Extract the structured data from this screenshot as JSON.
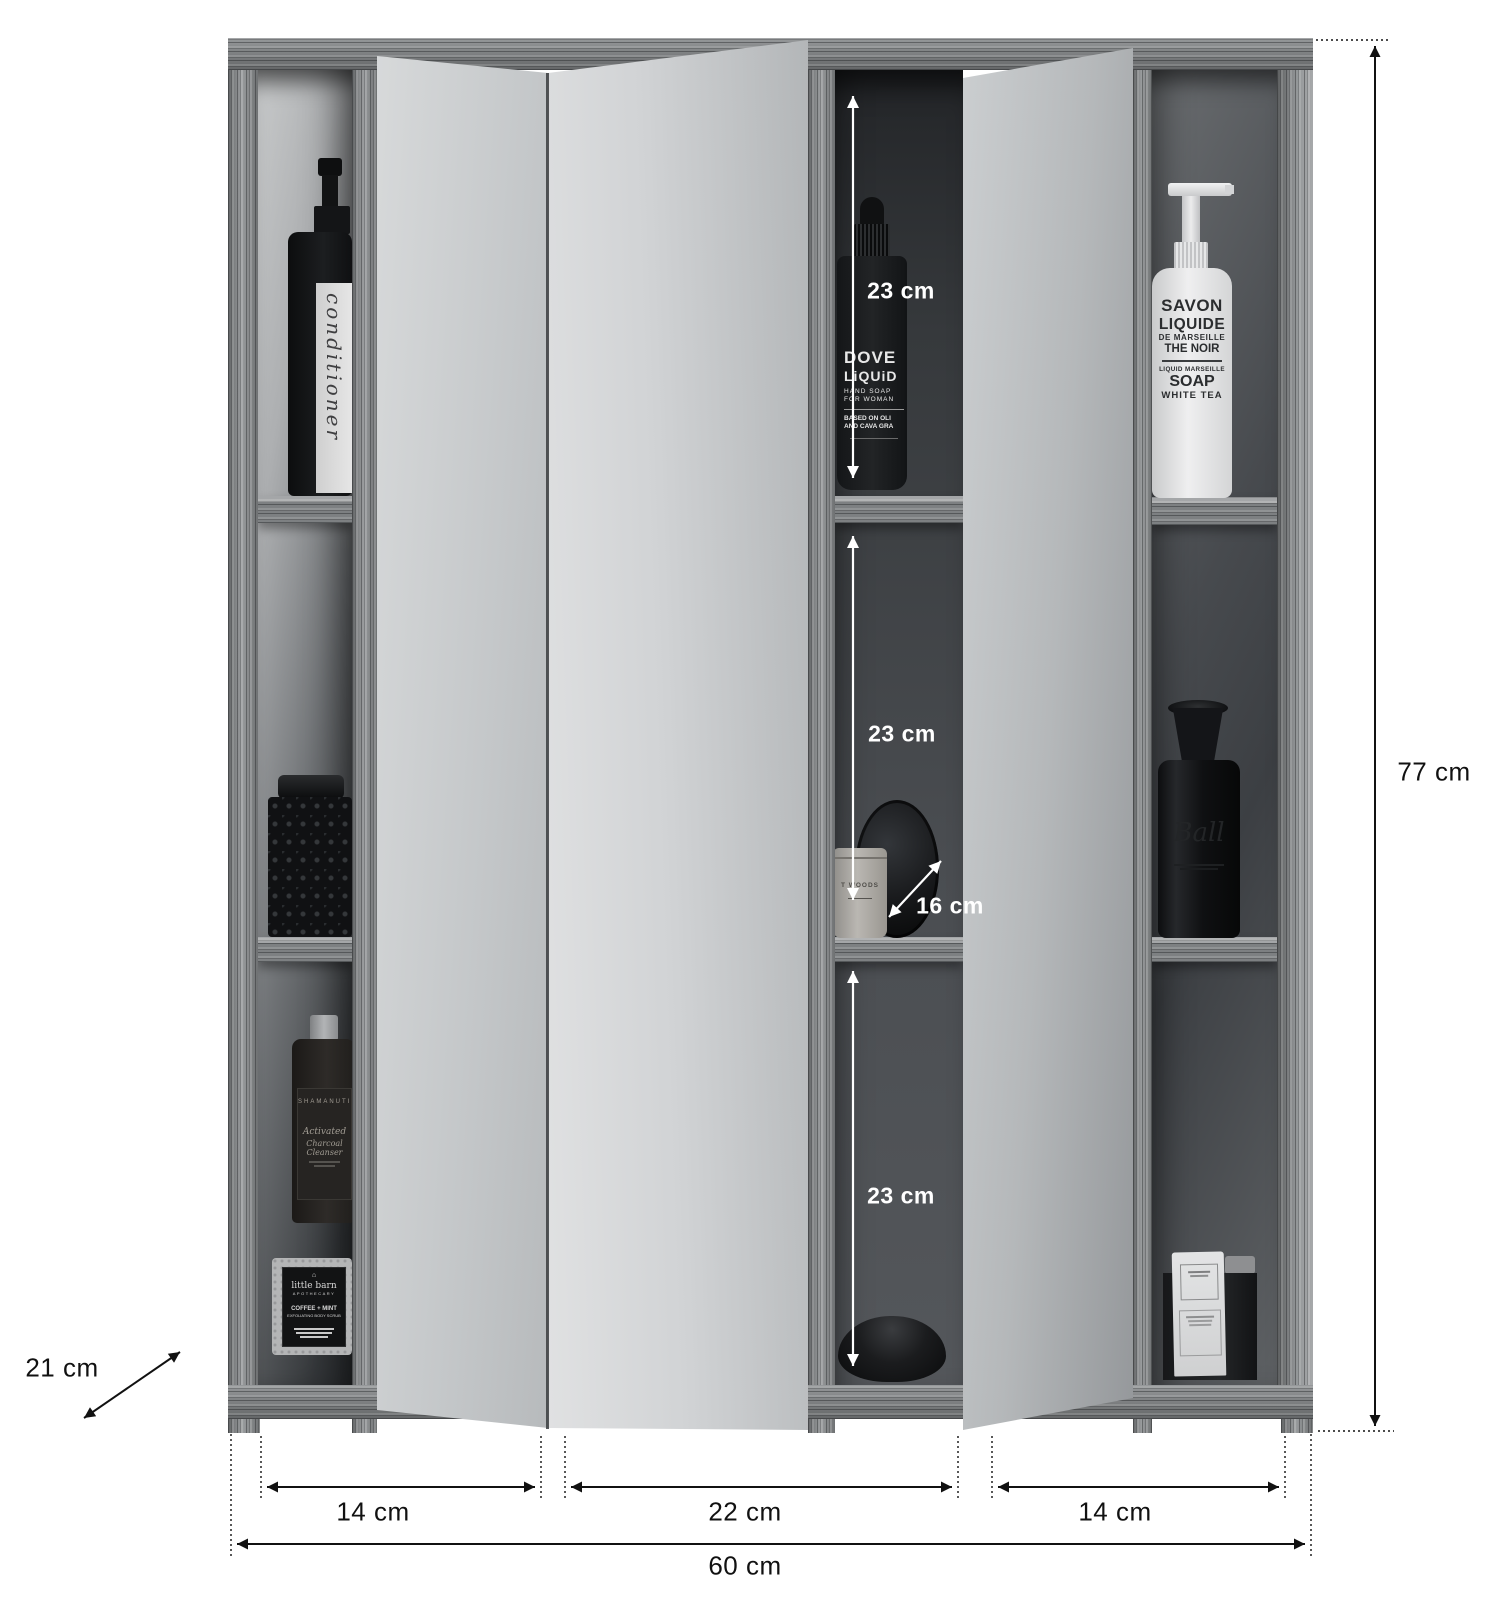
{
  "dimensions": {
    "height": "77 cm",
    "width": "60 cm",
    "depth": "21 cm",
    "left_door": "14 cm",
    "center": "22 cm",
    "right_door": "14 cm",
    "shelf_top": "23 cm",
    "shelf_mid": "23 cm",
    "shelf_bottom": "23 cm",
    "inner_depth": "16 cm"
  },
  "products": {
    "conditioner_bottle": {
      "label": "conditioner"
    },
    "dropper_bottle": {
      "lines": [
        "DOVE",
        "LiQUiD",
        "HAND SOAP",
        "FOR WOMAN",
        "BASED ON OLI",
        "AND CAVA GRA"
      ]
    },
    "soap_bottle": {
      "lines": [
        "SAVON",
        "LIQUIDE",
        "DE MARSEILLE",
        "THE NOIR",
        "LIQUID MARSEILLE",
        "SOAP",
        "WHITE TEA"
      ]
    },
    "cleanser_bottle": {
      "lines": [
        "SHAMANUTI",
        "Activated",
        "Charcoal Cleanser"
      ]
    },
    "scrub_jar": {
      "lines": [
        "little barn",
        "APOTHECARY",
        "COFFEE + MINT",
        "EXFOLIATING BODY SCRUB"
      ]
    },
    "candle_jar": {
      "label": "T WOODS"
    },
    "black_bottle": {
      "label": "Ball"
    }
  },
  "colors": {
    "annotation_dark": "#111111",
    "annotation_light": "#ffffff",
    "wood": "#8e9193",
    "mirror": "#cfd2d4"
  }
}
